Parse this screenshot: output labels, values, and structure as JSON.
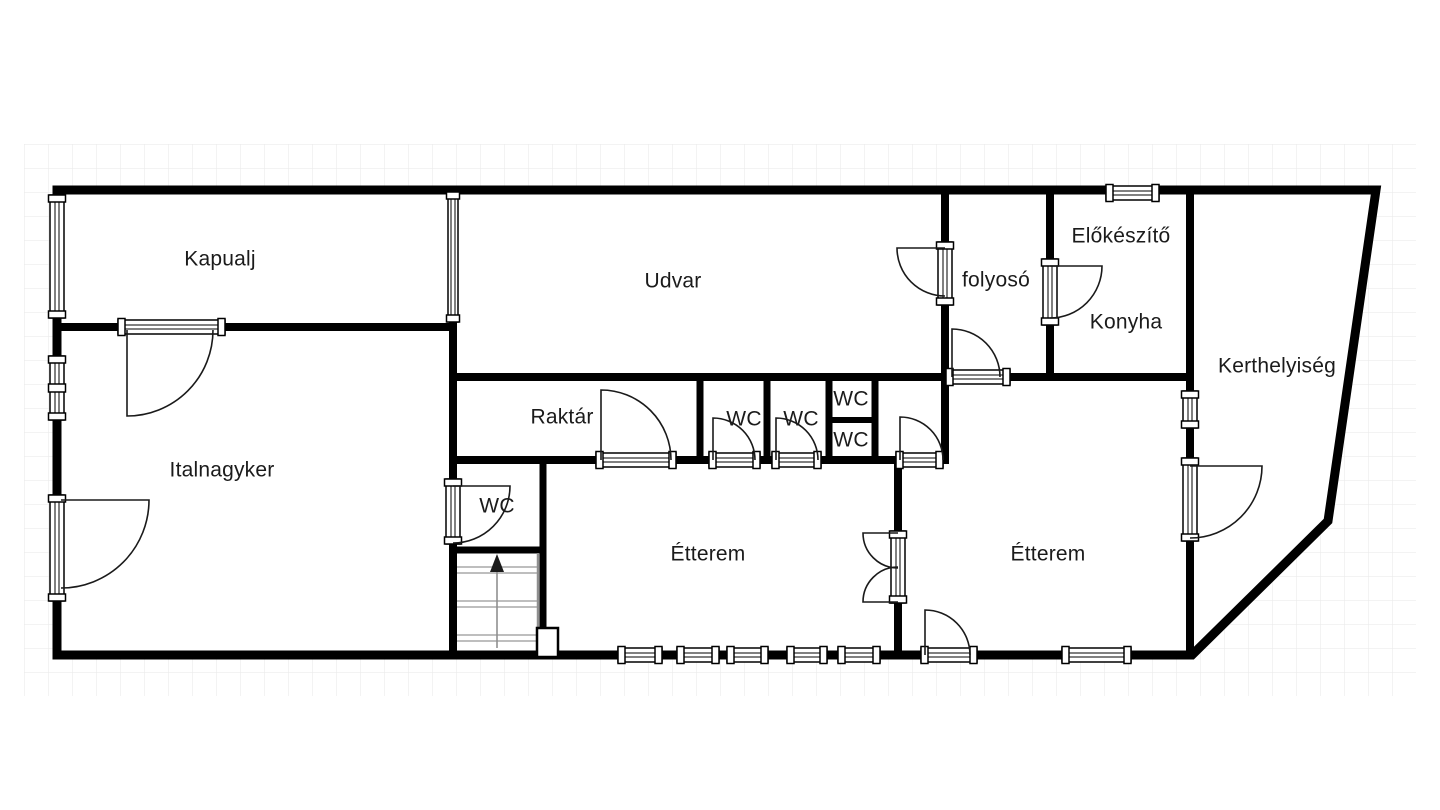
{
  "plan": {
    "title": "floor-plan",
    "colors": {
      "wall": "#000000",
      "grid": "#ececec",
      "stair_tread": "#a9a9a9",
      "label_text": "#1b1b1b"
    },
    "stairs": {
      "direction": "up"
    },
    "rooms": [
      {
        "id": "kapualj",
        "label": "Kapualj"
      },
      {
        "id": "udvar",
        "label": "Udvar"
      },
      {
        "id": "folyoso",
        "label": "folyosó"
      },
      {
        "id": "elokeszito",
        "label": "Előkészítő"
      },
      {
        "id": "konyha",
        "label": "Konyha"
      },
      {
        "id": "kerthelyiseg",
        "label": "Kerthelyiség"
      },
      {
        "id": "raktar",
        "label": "Raktár"
      },
      {
        "id": "wc-stall-1",
        "label": "WC"
      },
      {
        "id": "wc-stall-2",
        "label": "WC"
      },
      {
        "id": "wc-upper",
        "label": "WC"
      },
      {
        "id": "wc-lower",
        "label": "WC"
      },
      {
        "id": "italnagyker",
        "label": "Italnagyker"
      },
      {
        "id": "wc-stairs",
        "label": "WC"
      },
      {
        "id": "etterem-left",
        "label": "Étterem"
      },
      {
        "id": "etterem-right",
        "label": "Étterem"
      }
    ]
  }
}
